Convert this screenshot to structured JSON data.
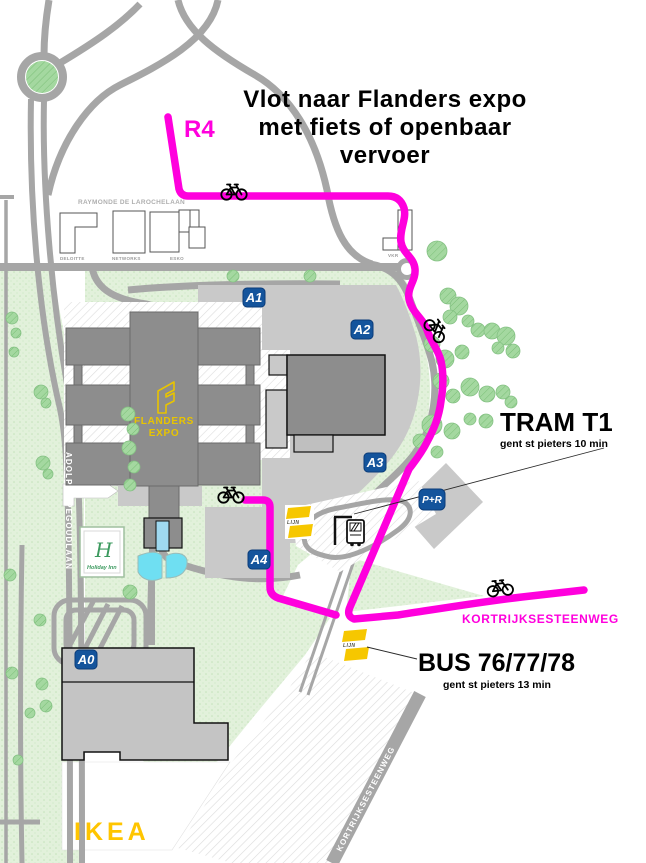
{
  "title": {
    "line1": "Vlot naar Flanders expo",
    "line2": "met fiets of openbaar",
    "line3": "vervoer"
  },
  "route": {
    "label": "R4"
  },
  "streets": {
    "kortrijksesteenweg": "KORTRIJKSESTEENWEG",
    "adolphe_pegoudlaan": "ADOLPHE PEGOUDLAAN",
    "raymonde_de_larochelaan": "RAYMONDE DE LAROCHELAAN"
  },
  "transit": {
    "tram": {
      "name": "TRAM T1",
      "detail": "gent st pieters 10 min"
    },
    "bus": {
      "name": "BUS 76/77/78",
      "detail": "gent st pieters 13  min"
    },
    "operator_logo": "LIJN"
  },
  "halls": {
    "a0": "A0",
    "a1": "A1",
    "a2": "A2",
    "a3": "A3",
    "a4": "A4"
  },
  "parking": {
    "pr": "P+R"
  },
  "venues": {
    "flanders_expo": {
      "line1": "FLANDERS",
      "line2": "EXPO"
    },
    "ikea": "IKEA",
    "holiday_inn": {
      "initial": "H",
      "name": "Holiday Inn"
    },
    "deloitte": "DELOITTE",
    "networks": "NETWORKS",
    "esko": "ESKO",
    "vkr": "VKR"
  },
  "colors": {
    "route_magenta": "#FF00DD",
    "badge_blue": "#14549C",
    "delijn_yellow": "#F6C700",
    "ikea_yellow": "#FFC500",
    "road_gray": "#A6A6A6",
    "hall_gray": "#8D8D8D",
    "plaza_gray": "#C9C9C9",
    "ground_green": "#E2F1DB",
    "pond_cyan": "#6FDFF2"
  }
}
